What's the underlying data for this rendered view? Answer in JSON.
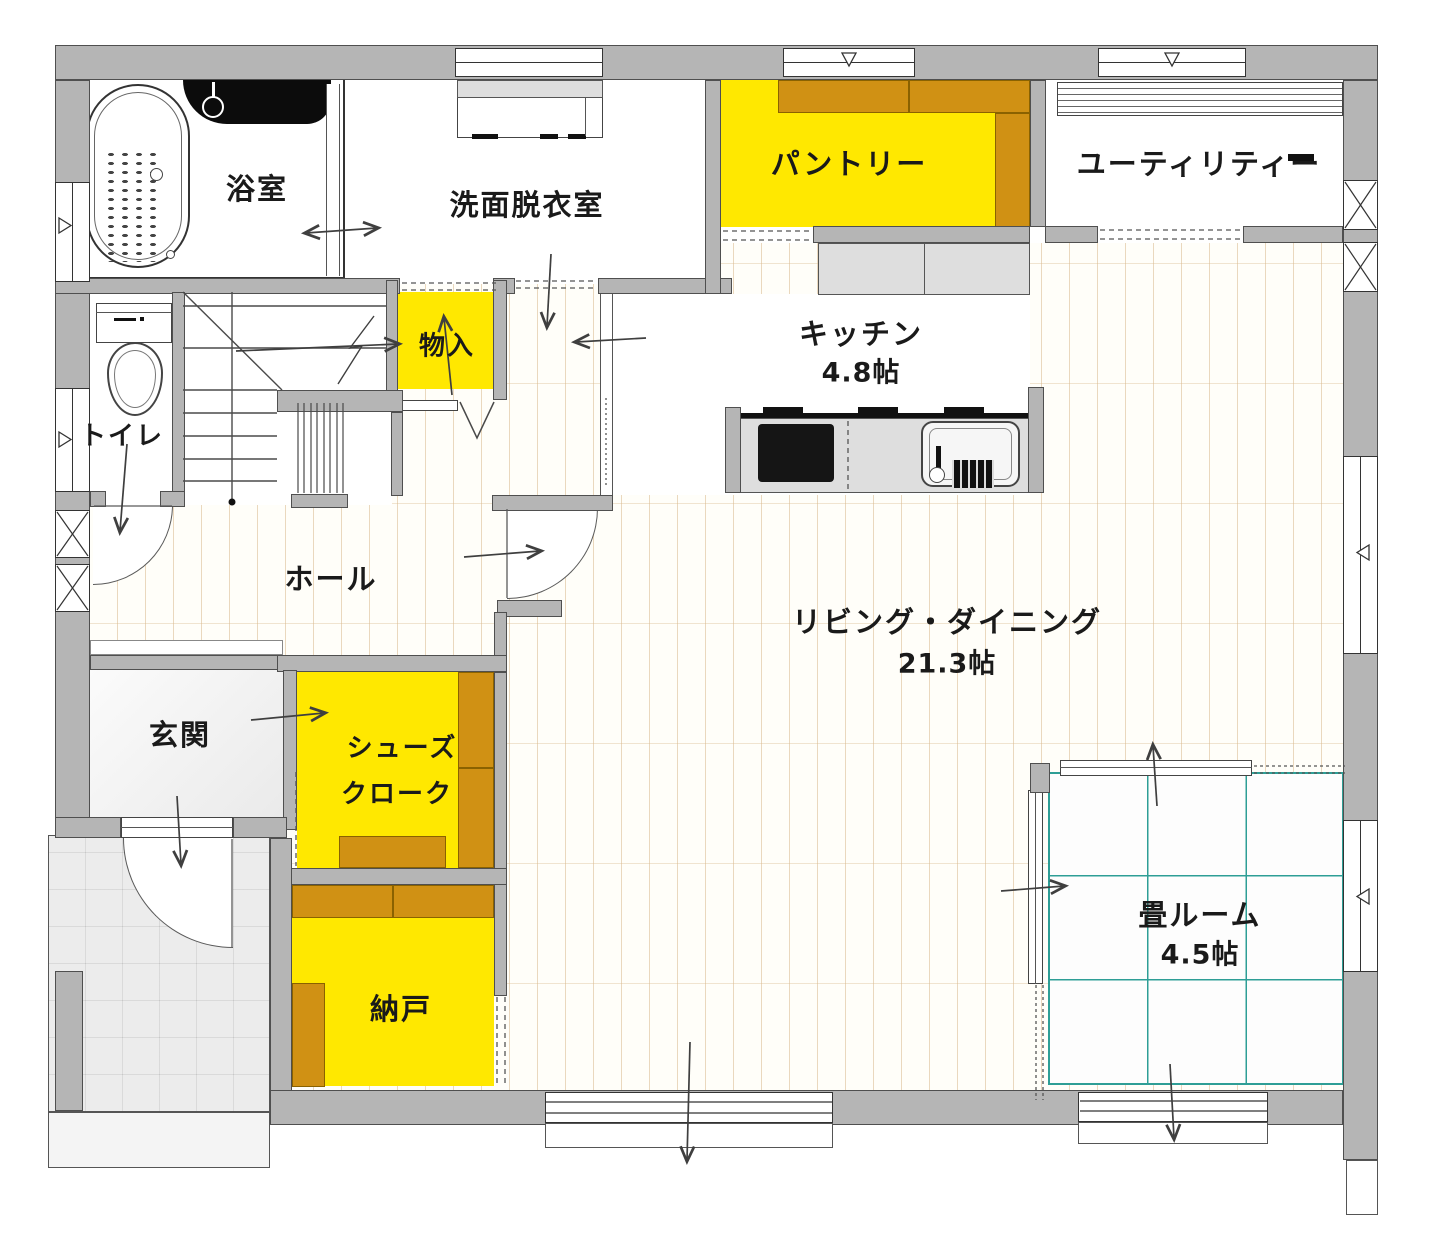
{
  "rooms": {
    "bath": {
      "label": "浴室"
    },
    "washroom": {
      "label": "洗面脱衣室"
    },
    "pantry": {
      "label": "パントリー"
    },
    "utility": {
      "label": "ユーティリティー"
    },
    "kitchen": {
      "label": "キッチン",
      "size": "4.8帖"
    },
    "closet": {
      "label": "物入"
    },
    "toilet": {
      "label": "トイレ"
    },
    "hall": {
      "label": "ホール"
    },
    "living": {
      "label": "リビング・ダイニング",
      "size": "21.3帖"
    },
    "entrance": {
      "label": "玄関"
    },
    "shoe_closet": {
      "line1": "シューズ",
      "line2": "クローク"
    },
    "storeroom": {
      "label": "納戸"
    },
    "tatami": {
      "label": "畳ルーム",
      "size": "4.5帖"
    }
  },
  "colors": {
    "highlight_yellow": "#FFE800",
    "shelf_brown": "#D09114",
    "wall_gray": "#B5B5B5",
    "tatami_grid_teal": "#2E9E96",
    "wood_joint": "#E9D7BC",
    "tile_gray": "#ECECEC",
    "label_text": "#1A1A1A"
  }
}
